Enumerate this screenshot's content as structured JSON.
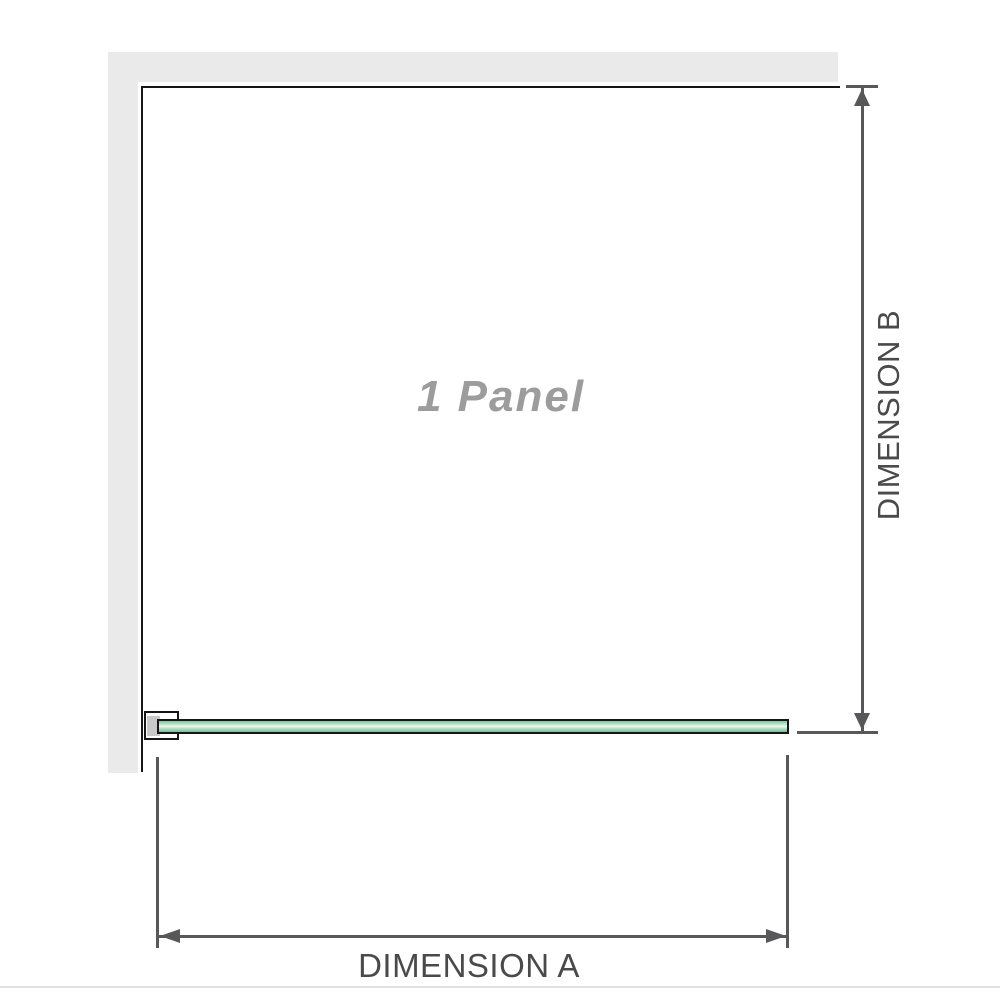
{
  "diagram": {
    "panel_label": "1 Panel",
    "dimension_a": {
      "label": "DIMENSION A"
    },
    "dimension_b": {
      "label": "DIMENSION B"
    },
    "colors": {
      "wall_gray": "#eaeaea",
      "outline_black": "#161616",
      "dimension_line_gray": "#58585a",
      "dimension_label_text": "#4a4a4a",
      "panel_label_text": "#9c9c9c",
      "glass_green": "#8fcba6",
      "glass_highlight": "#eef8f2",
      "bracket_pad_gray": "#c9c9c9",
      "bottom_divider_gray": "#e0e0e0"
    }
  }
}
